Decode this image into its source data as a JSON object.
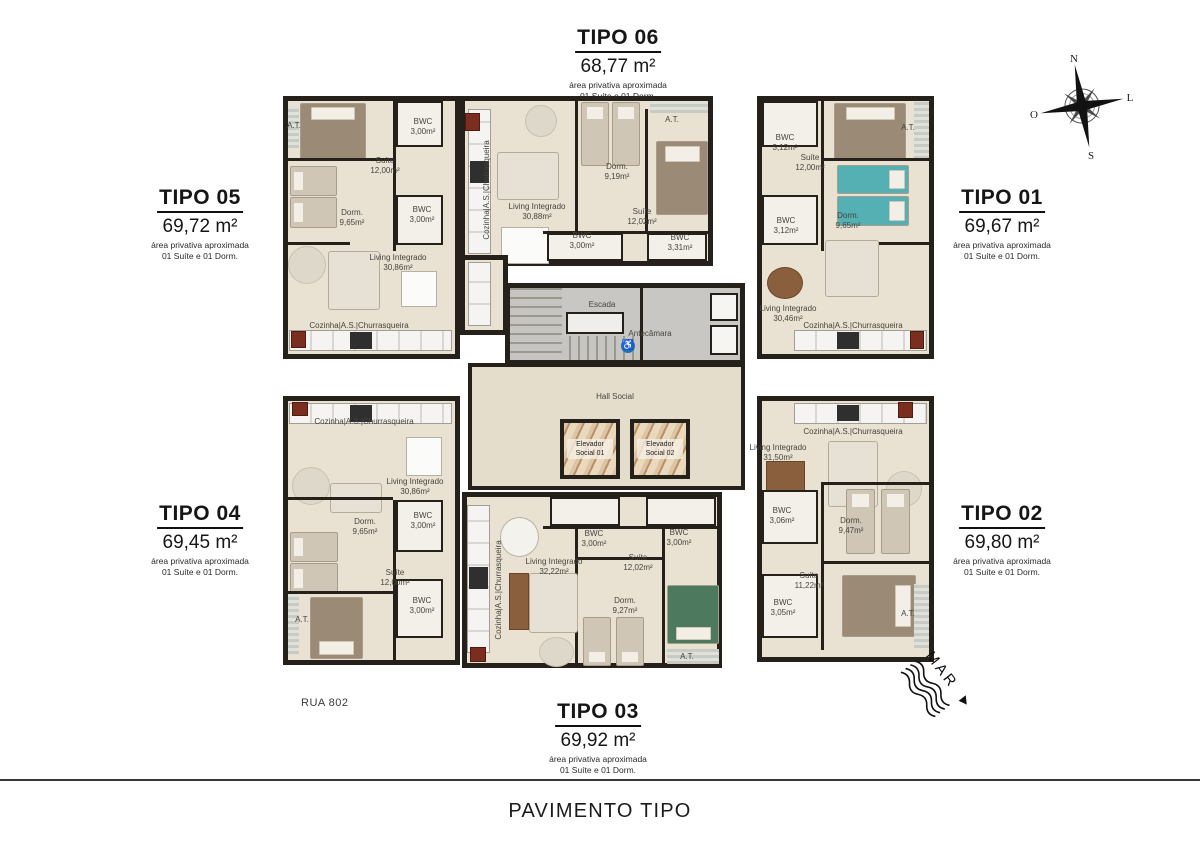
{
  "page_title": "PAVIMENTO TIPO",
  "street_label": "RUA 802",
  "sea_label": "MAR",
  "compass": {
    "north": "N",
    "east": "L",
    "south": "S",
    "west": "O"
  },
  "units": {
    "t05": {
      "name": "TIPO 05",
      "area": "69,72 m²",
      "note1": "área privativa aproximada",
      "note2": "01 Suíte e 01 Dorm."
    },
    "t06": {
      "name": "TIPO 06",
      "area": "68,77 m²",
      "note1": "área privativa aproximada",
      "note2": "01 Suíte e 01 Dorm."
    },
    "t01": {
      "name": "TIPO 01",
      "area": "69,67 m²",
      "note1": "área privativa aproximada",
      "note2": "01 Suíte e 01 Dorm."
    },
    "t04": {
      "name": "TIPO 04",
      "area": "69,45 m²",
      "note1": "área privativa aproximada",
      "note2": "01 Suíte e 01 Dorm."
    },
    "t03": {
      "name": "TIPO 03",
      "area": "69,92 m²",
      "note1": "área privativa aproximada",
      "note2": "01 Suíte e 01 Dorm."
    },
    "t02": {
      "name": "TIPO 02",
      "area": "69,80 m²",
      "note1": "área privativa aproximada",
      "note2": "01 Suíte e 01 Dorm."
    }
  },
  "core": {
    "escada": "Escada",
    "antecamara": "Antecâmara",
    "hall": "Hall Social",
    "elev1": "Elevador Social 01",
    "elev2": "Elevador Social 02",
    "accessibility_icon": "♿"
  },
  "rooms": {
    "t05": [
      {
        "name": "A.T.",
        "area": ""
      },
      {
        "name": "Suíte",
        "area": "12,00m²"
      },
      {
        "name": "BWC",
        "area": "3,00m²"
      },
      {
        "name": "Dorm.",
        "area": "9,65m²"
      },
      {
        "name": "BWC",
        "area": "3,00m²"
      },
      {
        "name": "Living Integrado",
        "area": "30,86m²"
      },
      {
        "name": "Cozinha|A.S.|Churrasqueira",
        "area": ""
      }
    ],
    "t06": [
      {
        "name": "Cozinha|A.S.|Churrasqueira",
        "area": ""
      },
      {
        "name": "Living Integrado",
        "area": "30,88m²"
      },
      {
        "name": "Dorm.",
        "area": "9,19m²"
      },
      {
        "name": "A.T.",
        "area": ""
      },
      {
        "name": "Suíte",
        "area": "12,02m²"
      },
      {
        "name": "BWC",
        "area": "3,00m²"
      },
      {
        "name": "BWC",
        "area": "3,31m²"
      }
    ],
    "t01": [
      {
        "name": "BWC",
        "area": "3,12m²"
      },
      {
        "name": "Suíte",
        "area": "12,00m²"
      },
      {
        "name": "A.T.",
        "area": ""
      },
      {
        "name": "Dorm.",
        "area": "9,65m²"
      },
      {
        "name": "BWC",
        "area": "3,12m²"
      },
      {
        "name": "Living Integrado",
        "area": "30,46m²"
      },
      {
        "name": "Cozinha|A.S.|Churrasqueira",
        "area": ""
      }
    ],
    "t04": [
      {
        "name": "Cozinha|A.S.|Churrasqueira",
        "area": ""
      },
      {
        "name": "Living Integrado",
        "area": "30,86m²"
      },
      {
        "name": "Dorm.",
        "area": "9,65m²"
      },
      {
        "name": "BWC",
        "area": "3,00m²"
      },
      {
        "name": "Suíte",
        "area": "12,00m²"
      },
      {
        "name": "BWC",
        "area": "3,00m²"
      },
      {
        "name": "A.T.",
        "area": ""
      }
    ],
    "t03": [
      {
        "name": "Cozinha|A.S.|Churrasqueira",
        "area": ""
      },
      {
        "name": "Living Integrado",
        "area": "32,22m²"
      },
      {
        "name": "BWC",
        "area": "3,00m²"
      },
      {
        "name": "BWC",
        "area": "3,00m²"
      },
      {
        "name": "Suíte",
        "area": "12,02m²"
      },
      {
        "name": "Dorm.",
        "area": "9,27m²"
      },
      {
        "name": "A.T.",
        "area": ""
      }
    ],
    "t02": [
      {
        "name": "Cozinha|A.S.|Churrasqueira",
        "area": ""
      },
      {
        "name": "Living Integrado",
        "area": "31,50m²"
      },
      {
        "name": "BWC",
        "area": "3,06m²"
      },
      {
        "name": "Dorm.",
        "area": "9,47m²"
      },
      {
        "name": "Suíte",
        "area": "11,22m²"
      },
      {
        "name": "BWC",
        "area": "3,05m²"
      },
      {
        "name": "A.T.",
        "area": ""
      }
    ]
  }
}
